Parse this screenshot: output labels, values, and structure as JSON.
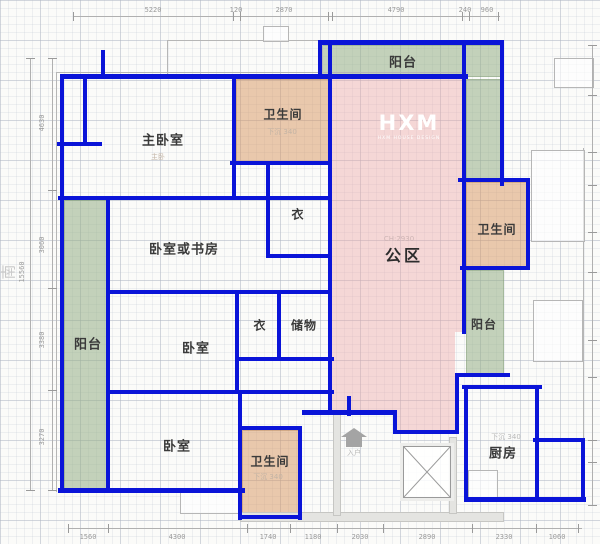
{
  "compass": {
    "south": "南"
  },
  "watermark": {
    "logo": "HXM",
    "tagline": "HXM HOUSE DESIGN"
  },
  "rooms": {
    "master_bedroom": {
      "label": "主卧室",
      "sublabel": "主卧"
    },
    "bath_top": {
      "label": "卫生间",
      "sublabel": "下沉 340"
    },
    "closet_upper": {
      "label": "衣"
    },
    "study": {
      "label": "卧室或书房"
    },
    "balcony_left": {
      "label": "阳台"
    },
    "bedroom_middle": {
      "label": "卧室"
    },
    "closet_lower": {
      "label": "衣"
    },
    "storage": {
      "label": "储物"
    },
    "bedroom_bottom": {
      "label": "卧室"
    },
    "bath_bottom": {
      "label": "卫生间",
      "sublabel": "下沉 340"
    },
    "public_area": {
      "label": "公区",
      "sublabel": "CH:2930"
    },
    "balcony_top": {
      "label": "阳台"
    },
    "bath_right": {
      "label": "卫生间"
    },
    "balcony_right": {
      "label": "阳台"
    },
    "kitchen": {
      "label": "厨房",
      "sublabel": "下沉 340"
    },
    "entry": {
      "label": "入户"
    }
  },
  "dimensions": {
    "top": [
      "5220",
      "120",
      "2870",
      "4790",
      "240",
      "960"
    ],
    "left_total": "15560",
    "left": [
      "4630",
      "3060",
      "3380",
      "3270"
    ],
    "bottom": [
      "1560",
      "4300",
      "1740",
      "1180",
      "2030",
      "2890",
      "2330",
      "1060"
    ]
  },
  "colors": {
    "wall_blue": "#0a14d8",
    "balcony_green": "#96af87",
    "bathroom_tan": "#d7965f",
    "public_pink": "#eea3a3"
  }
}
